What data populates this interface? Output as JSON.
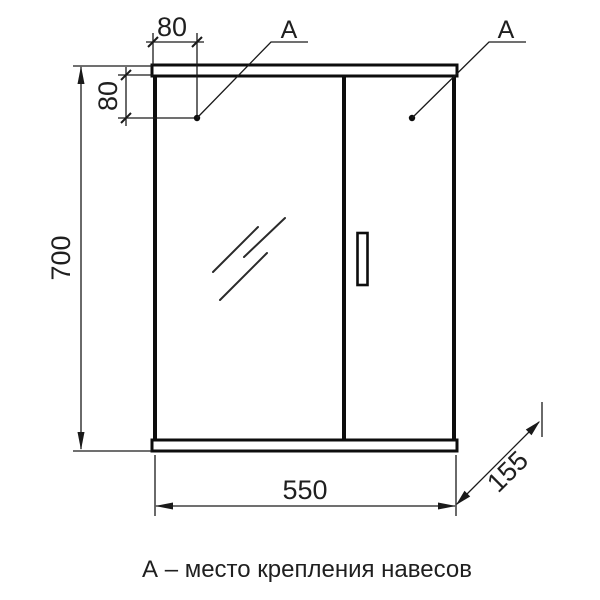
{
  "drawing": {
    "caption": "А – место крепления навесов",
    "callout_label": "А",
    "dimensions": {
      "width": "550",
      "height": "700",
      "depth": "155",
      "mount_offset_x": "80",
      "mount_offset_y": "80"
    },
    "colors": {
      "line": "#1a1a1a",
      "background": "#ffffff"
    }
  }
}
